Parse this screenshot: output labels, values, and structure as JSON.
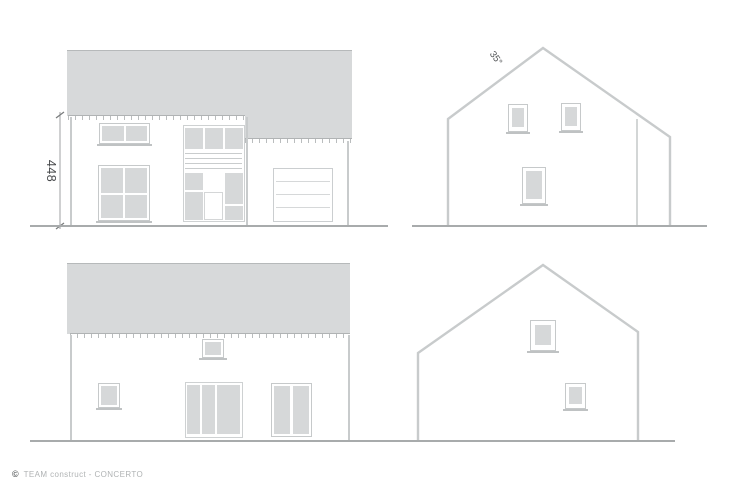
{
  "annotations": {
    "height_dimension": "448",
    "roof_pitch_angle": "35°"
  },
  "footer": {
    "copyright_symbol": "©",
    "brand": "TEAM construct - CONCERTO"
  },
  "colors": {
    "roof_fill": "#d7d9da",
    "ridge_line": "#b6b9ba",
    "pane_fill": "#d6d8d9",
    "frame_line": "#c6c9ca",
    "outline": "#c8cbcc",
    "ground_line": "#a8abac",
    "fascia_line": "#b0b3b4",
    "fascia_tick": "#babdbe",
    "sill_line": "#bfc2c3",
    "door_line": "#d6d8d9",
    "dim_text": "#46484a",
    "angle_text": "#505254",
    "footer_text": "#b0b3b4",
    "copyright_color": "#5a5d5e"
  }
}
